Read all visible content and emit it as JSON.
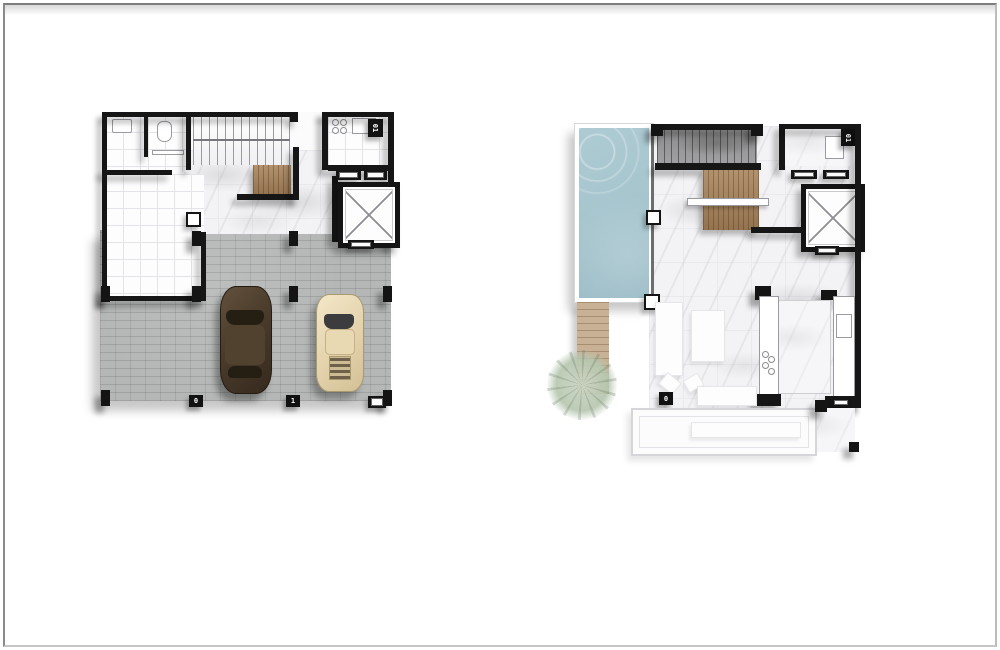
{
  "page": {
    "background": "#ffffff",
    "frame_color": "#7d7d7d"
  },
  "left_plan": {
    "corner_marker": "01",
    "garage_marker_a": "0",
    "garage_marker_b": "1"
  },
  "right_plan": {
    "corner_marker": "01",
    "floor_marker": "0"
  },
  "colors": {
    "wall": "#161616",
    "paver_gray": "#b4b7b5",
    "marble": "#f3f3f5",
    "wood": "#a8835a",
    "deck_wood": "#c8b195",
    "pool_water": "#a5c4cd",
    "stairwell_dark": "#a0a0a2",
    "sedan_brown": "#4a3b2b",
    "sport_cream": "#e5d4ae",
    "tree_green": "#b7c7b0"
  }
}
